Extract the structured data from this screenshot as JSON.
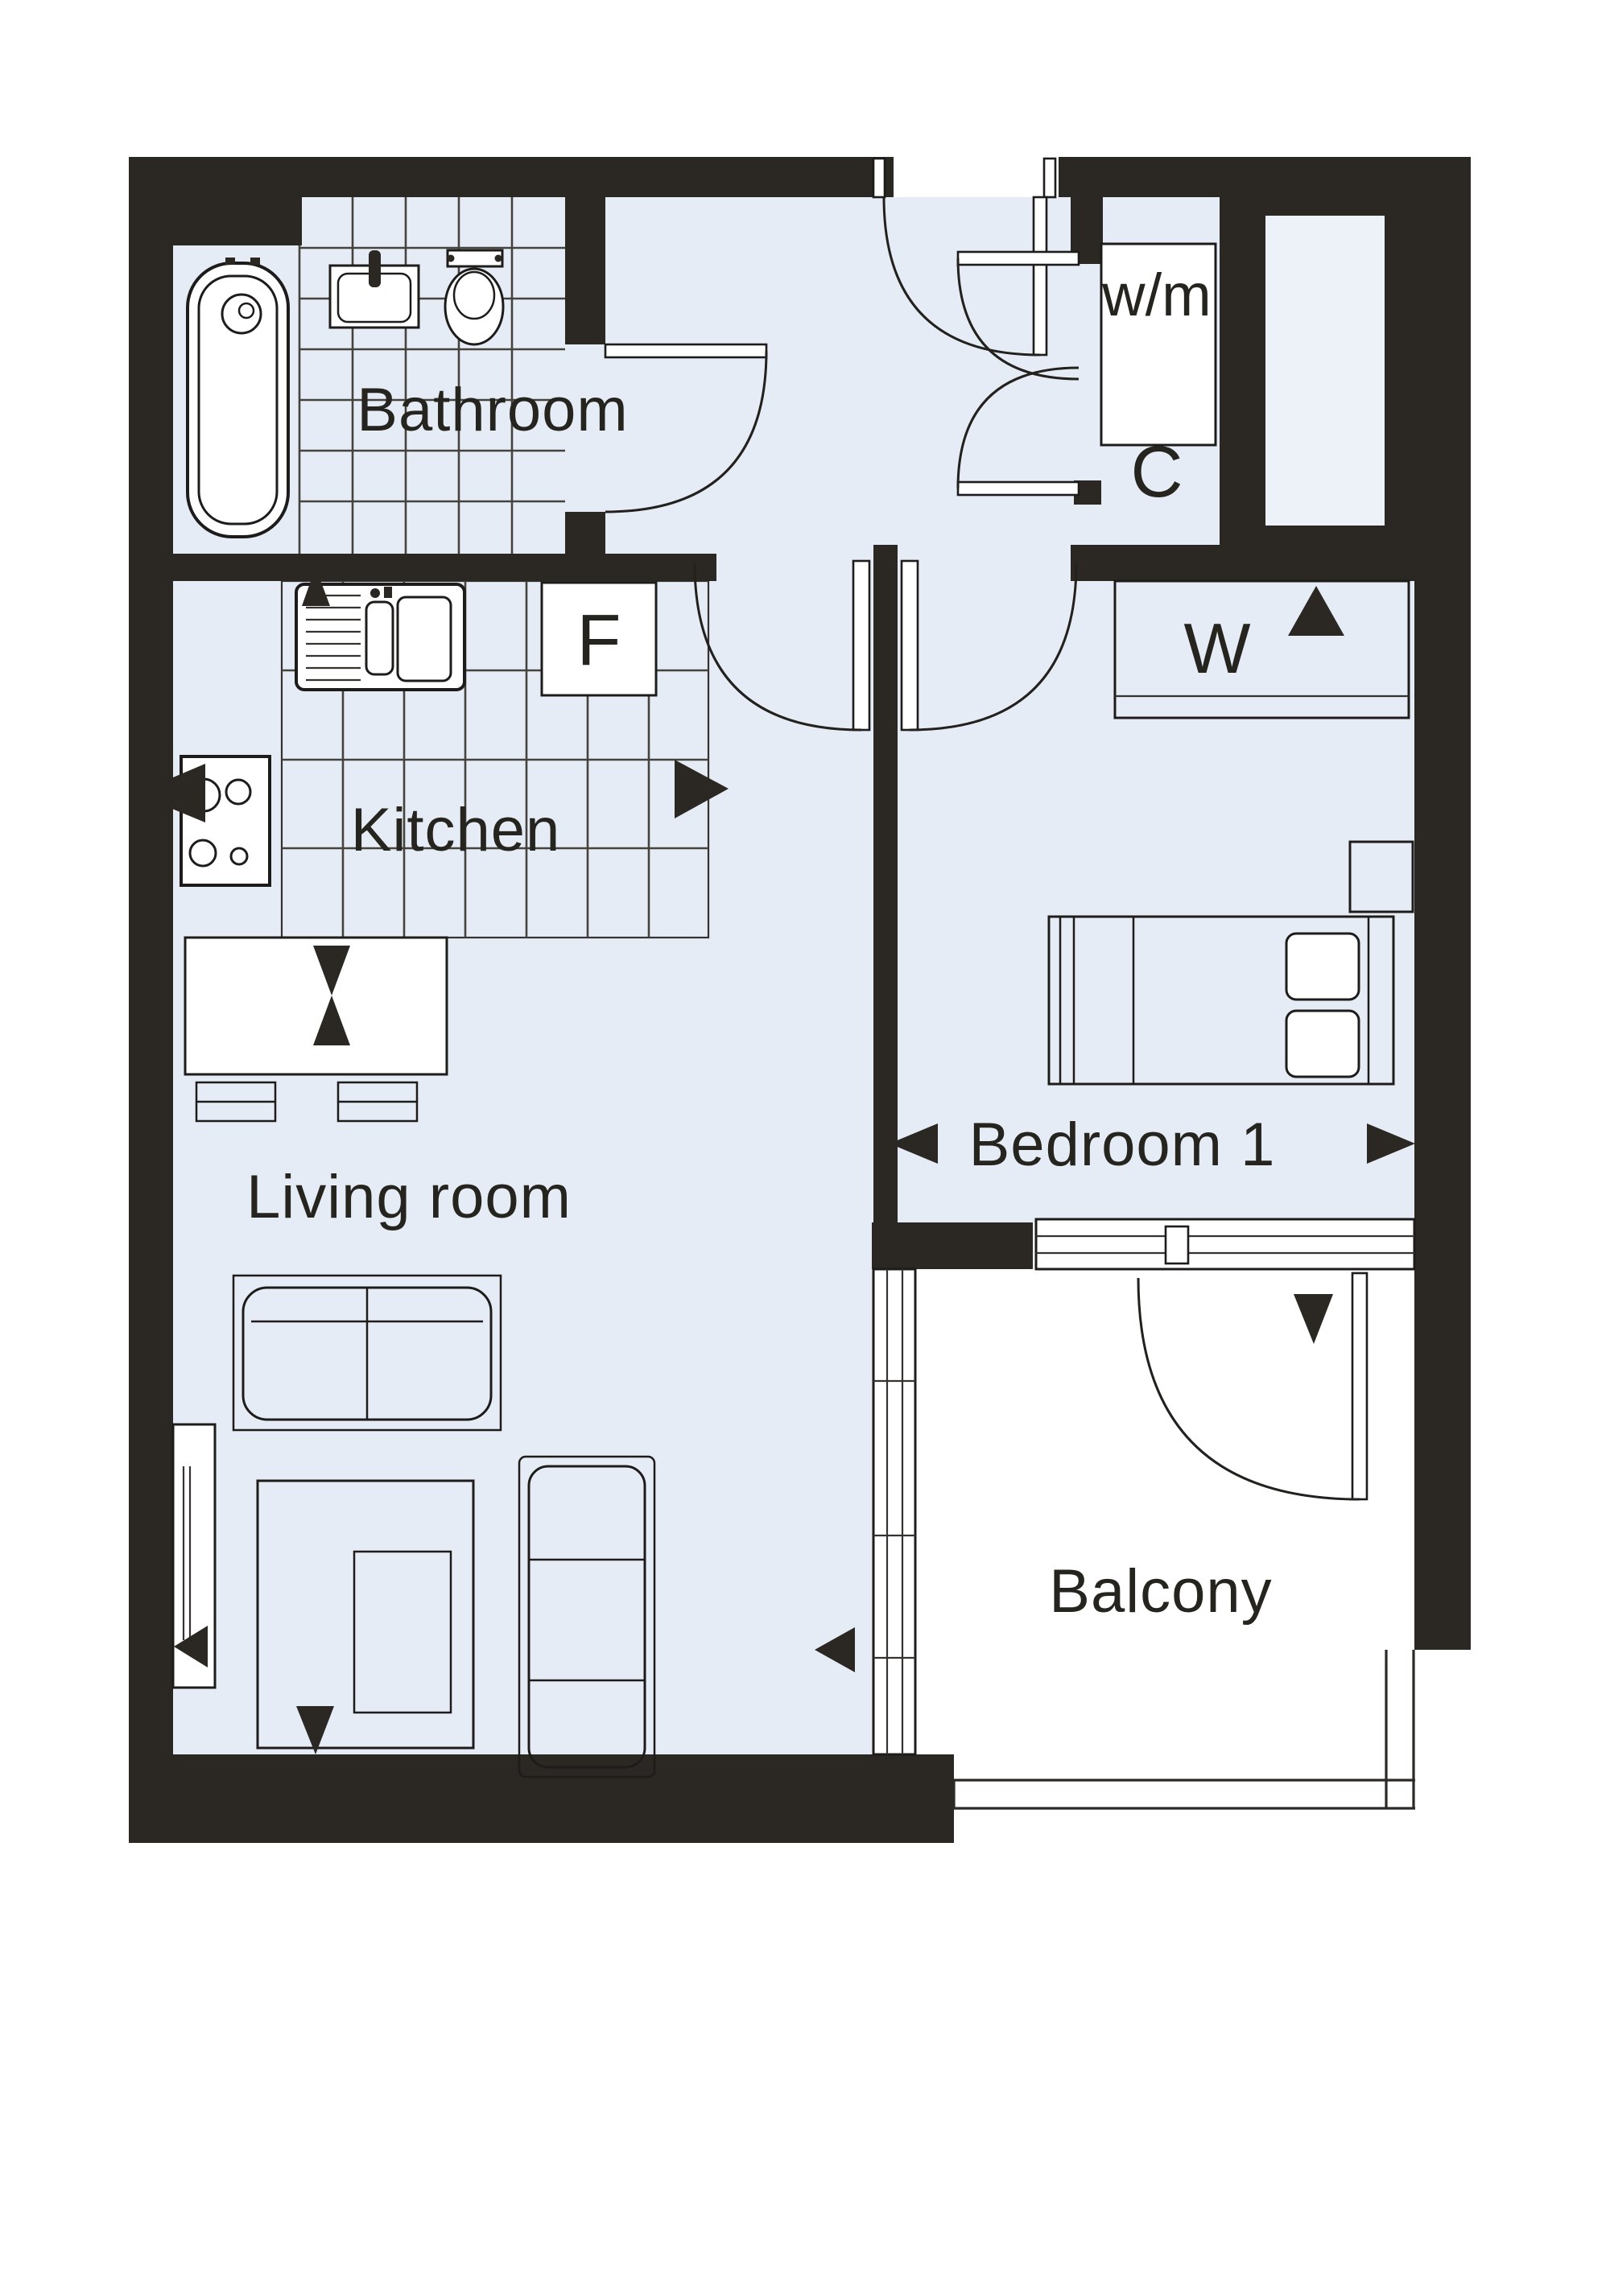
{
  "plan": {
    "type": "apartment-floor-plan",
    "rooms": {
      "bathroom": {
        "label": "Bathroom"
      },
      "kitchen": {
        "label": "Kitchen"
      },
      "living_room": {
        "label": "Living room"
      },
      "bedroom": {
        "label": "Bedroom 1"
      },
      "balcony": {
        "label": "Balcony"
      }
    },
    "fixtures": {
      "washing_machine": {
        "label": "w/m"
      },
      "cupboard": {
        "label": "C"
      },
      "fridge": {
        "label": "F"
      },
      "wardrobe": {
        "label": "W"
      }
    },
    "colors": {
      "wall": "#2b2823",
      "floor": "#e6ecf5",
      "shaft": "#edf1f8",
      "line": "#1d1c1a",
      "paper": "#ffffff"
    }
  }
}
